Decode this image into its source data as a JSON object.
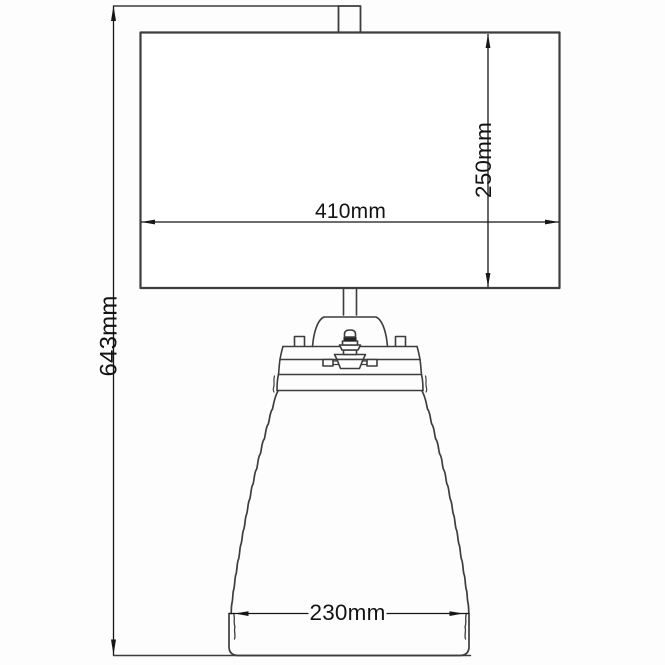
{
  "drawing": {
    "labels": {
      "total_height": "643mm",
      "shade_width": "410mm",
      "shade_height": "250mm",
      "base_width": "230mm"
    },
    "colors": {
      "background": "#fdfdfd",
      "geometry_line": "#3d3d3d",
      "dimension_line": "#161616",
      "label_text": "#131313"
    }
  }
}
